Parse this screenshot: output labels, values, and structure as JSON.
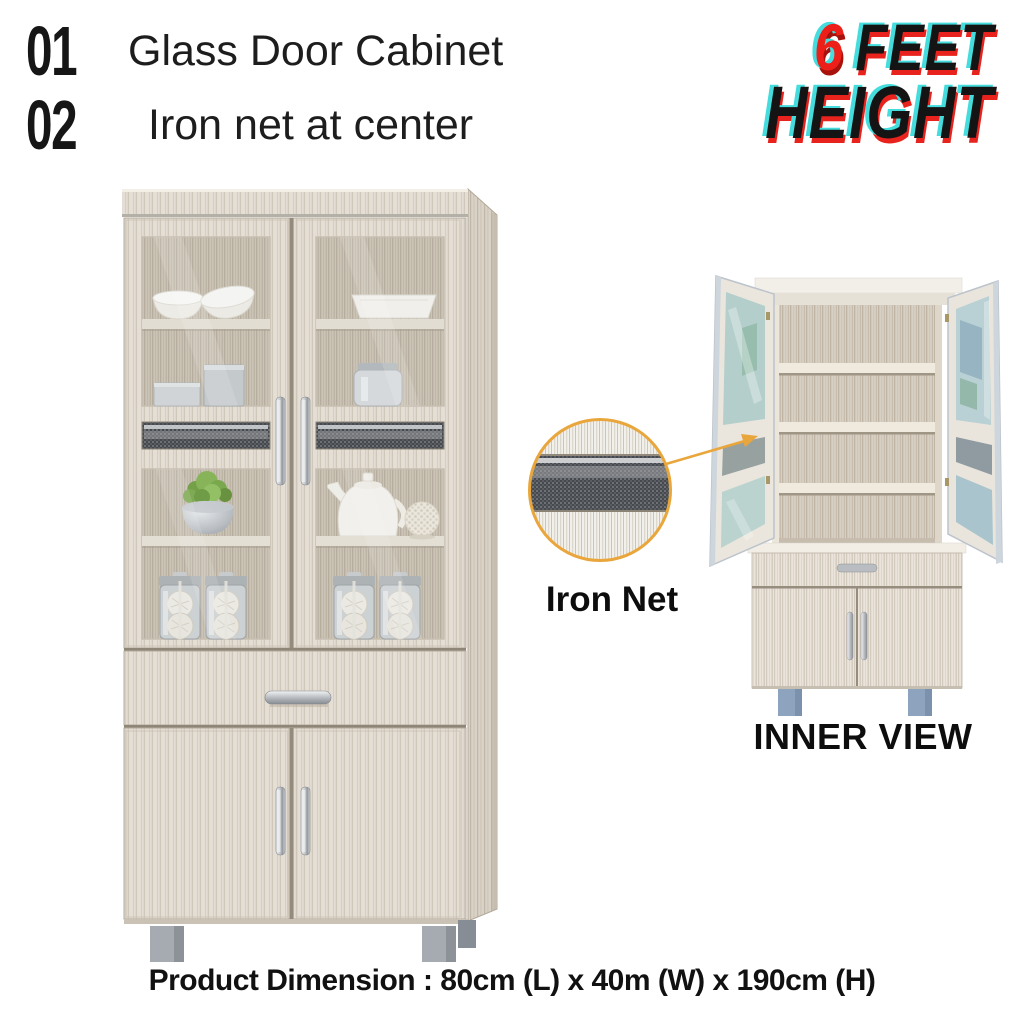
{
  "canvas": {
    "background": "#ffffff"
  },
  "features": {
    "items": [
      {
        "number": "01",
        "label": "Glass Door Cabinet"
      },
      {
        "number": "02",
        "label": "Iron net at center"
      }
    ]
  },
  "height_badge": {
    "number": "6",
    "word1": "FEET",
    "word2": "HEIGHT",
    "number_color": "#ed2019",
    "text_color": "#141414",
    "glitch_cyan": "#44dcdd",
    "glitch_red": "#e8231d"
  },
  "callout": {
    "label": "Iron Net",
    "ring_color": "#e9a63c"
  },
  "inner_view": {
    "label": "INNER VIEW"
  },
  "dimension_text": "Product Dimension : 80cm (L) x 40m (W) x 190cm (H)",
  "palette": {
    "wood_light": "#e9e3d9",
    "wood_stripe": "#cfc7ba",
    "wood_interior": "#cdc4b6",
    "handle_silver": "#c3c7cb",
    "leg_gray": "#a6abb2",
    "leg_blue_gray": "#8da3be",
    "iron_net_dark": "#4b4e52"
  }
}
